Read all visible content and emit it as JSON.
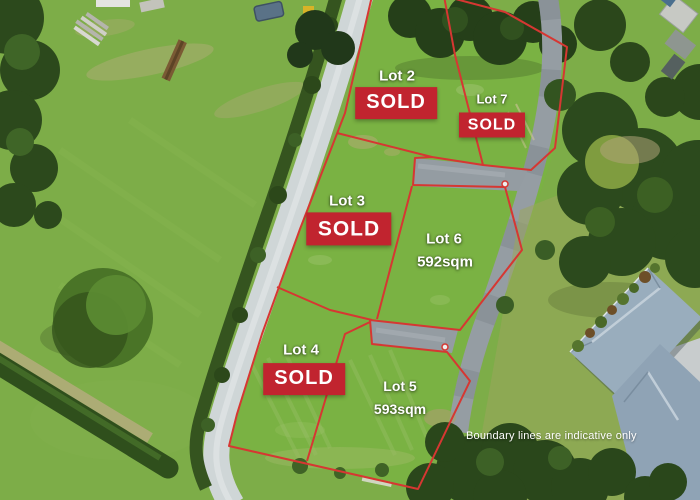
{
  "lots": [
    {
      "name": "Lot 2",
      "badge": "SOLD"
    },
    {
      "name": "Lot 7",
      "badge": "SOLD"
    },
    {
      "name": "Lot 3",
      "badge": "SOLD"
    },
    {
      "name": "Lot 6",
      "area": "592sqm"
    },
    {
      "name": "Lot 4",
      "badge": "SOLD"
    },
    {
      "name": "Lot 5",
      "area": "593sqm"
    }
  ],
  "disclaimer": "Boundary lines are indicative only",
  "colors": {
    "sold_badge_bg": "#c1242f",
    "sold_badge_text": "#ffffff",
    "boundary_line": "#d63732",
    "label_text": "#ffffff"
  }
}
